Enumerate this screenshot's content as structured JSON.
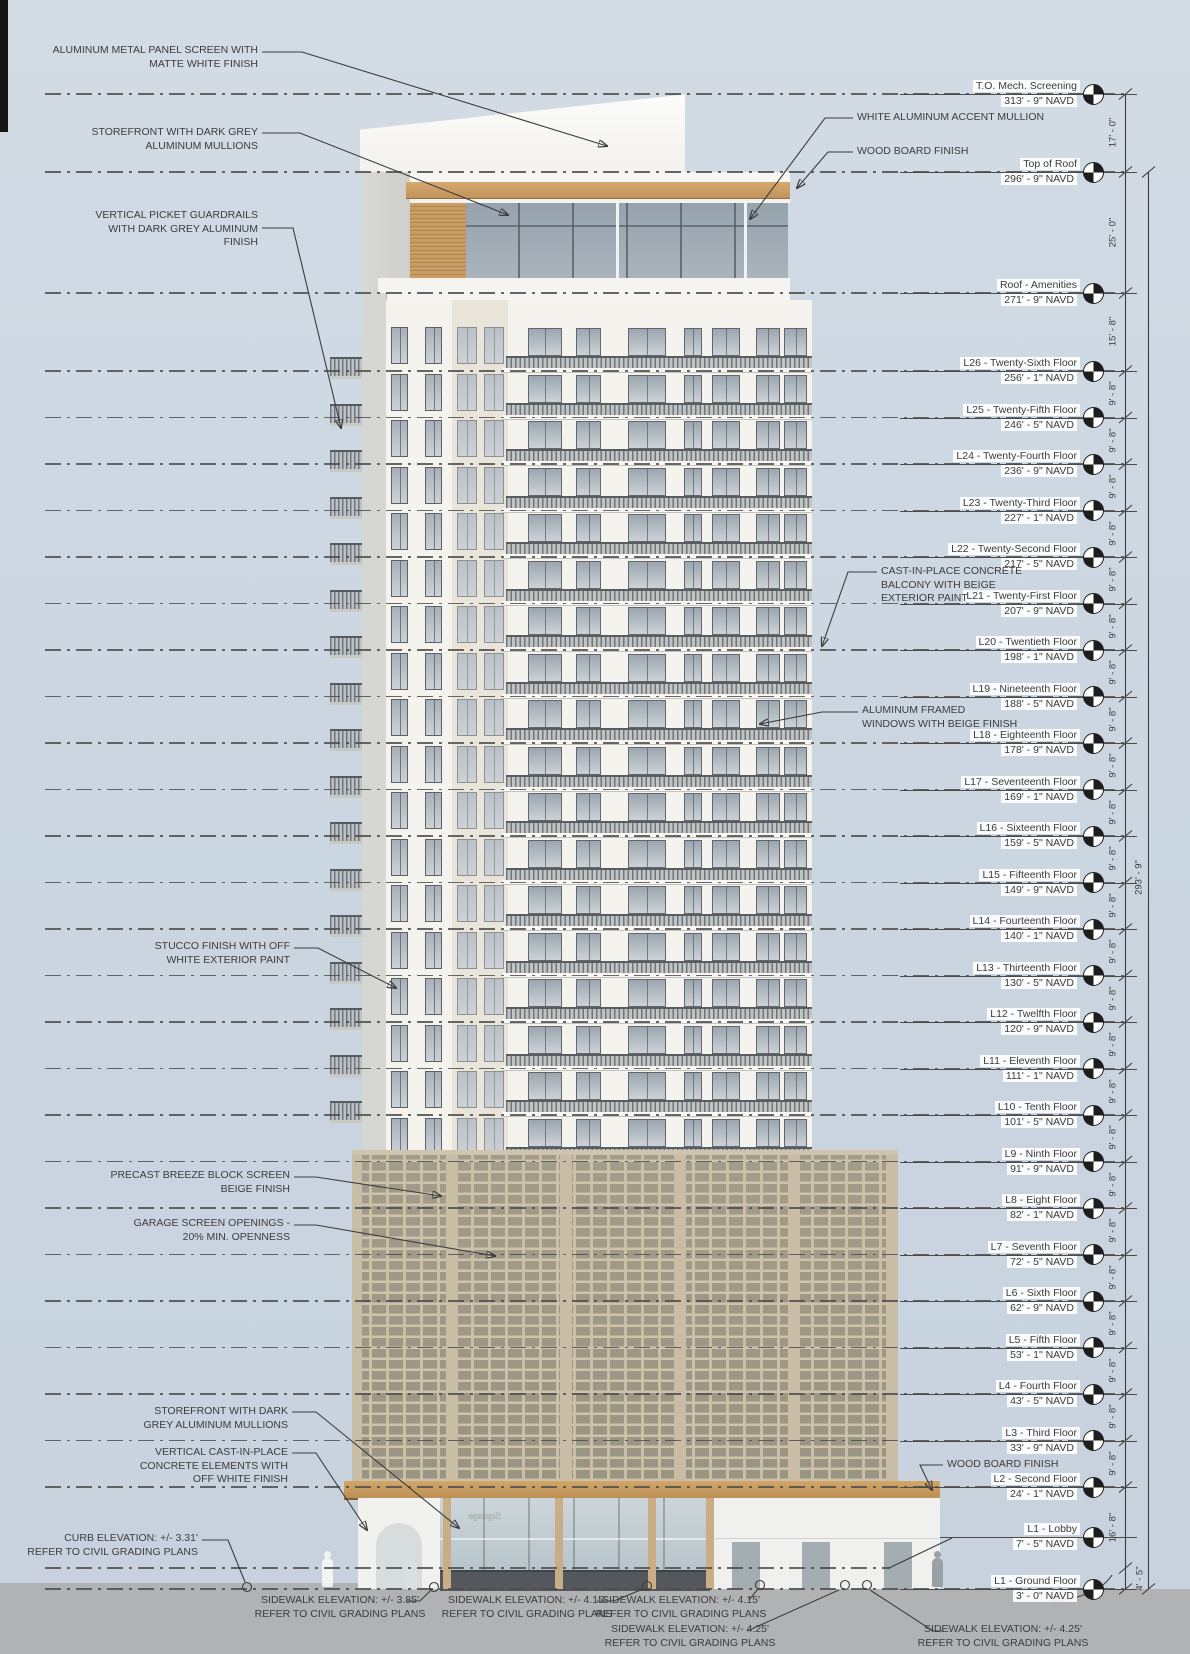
{
  "levels": [
    {
      "name": "T.O. Mech. Screening",
      "elevation": "313' - 9\" NAVD"
    },
    {
      "name": "Top of Roof",
      "elevation": "296' - 9\" NAVD"
    },
    {
      "name": "Roof - Amenities",
      "elevation": "271' - 9\" NAVD"
    },
    {
      "name": "L26 - Twenty-Sixth Floor",
      "elevation": "256' - 1\" NAVD"
    },
    {
      "name": "L25 - Twenty-Fifth Floor",
      "elevation": "246' - 5\" NAVD"
    },
    {
      "name": "L24 - Twenty-Fourth Floor",
      "elevation": "236' - 9\" NAVD"
    },
    {
      "name": "L23 - Twenty-Third Floor",
      "elevation": "227' - 1\" NAVD"
    },
    {
      "name": "L22 - Twenty-Second Floor",
      "elevation": "217' - 5\" NAVD"
    },
    {
      "name": "L21 - Twenty-First Floor",
      "elevation": "207' - 9\" NAVD"
    },
    {
      "name": "L20 - Twentieth Floor",
      "elevation": "198' - 1\" NAVD"
    },
    {
      "name": "L19 - Nineteenth Floor",
      "elevation": "188' - 5\" NAVD"
    },
    {
      "name": "L18 - Eighteenth Floor",
      "elevation": "178' - 9\" NAVD"
    },
    {
      "name": "L17 - Seventeenth Floor",
      "elevation": "169' - 1\" NAVD"
    },
    {
      "name": "L16 - Sixteenth Floor",
      "elevation": "159' - 5\" NAVD"
    },
    {
      "name": "L15 - Fifteenth Floor",
      "elevation": "149' - 9\" NAVD"
    },
    {
      "name": "L14 - Fourteenth Floor",
      "elevation": "140' - 1\" NAVD"
    },
    {
      "name": "L13 - Thirteenth Floor",
      "elevation": "130' - 5\" NAVD"
    },
    {
      "name": "L12 - Twelfth Floor",
      "elevation": "120' - 9\" NAVD"
    },
    {
      "name": "L11 - Eleventh Floor",
      "elevation": "111' - 1\" NAVD"
    },
    {
      "name": "L10 - Tenth Floor",
      "elevation": "101' - 5\" NAVD"
    },
    {
      "name": "L9 - Ninth Floor",
      "elevation": "91' - 9\" NAVD"
    },
    {
      "name": "L8 - Eight Floor",
      "elevation": "82' - 1\" NAVD"
    },
    {
      "name": "L7 - Seventh Floor",
      "elevation": "72' - 5\" NAVD"
    },
    {
      "name": "L6 - Sixth Floor",
      "elevation": "62' - 9\" NAVD"
    },
    {
      "name": "L5 - Fifth Floor",
      "elevation": "53' - 1\" NAVD"
    },
    {
      "name": "L4 - Fourth Floor",
      "elevation": "43' - 5\" NAVD"
    },
    {
      "name": "L3 - Third Floor",
      "elevation": "33' - 9\" NAVD"
    },
    {
      "name": "L2 - Second Floor",
      "elevation": "24' - 1\" NAVD"
    },
    {
      "name": "L1 - Lobby",
      "elevation": "7' - 5\" NAVD"
    },
    {
      "name": "L1 - Ground Floor",
      "elevation": "3' - 0\" NAVD"
    }
  ],
  "dimensions": {
    "intervals": [
      "17' - 0\"",
      "25' - 0\"",
      "15' - 8\"",
      "9' - 8\"",
      "9' - 8\"",
      "9' - 8\"",
      "9' - 8\"",
      "9' - 8\"",
      "9' - 8\"",
      "9' - 8\"",
      "9' - 8\"",
      "9' - 8\"",
      "9' - 8\"",
      "9' - 8\"",
      "9' - 8\"",
      "9' - 8\"",
      "9' - 8\"",
      "9' - 8\"",
      "9' - 8\"",
      "9' - 8\"",
      "9' - 8\"",
      "9' - 8\"",
      "9' - 8\"",
      "9' - 8\"",
      "9' - 8\"",
      "9' - 8\"",
      "9' - 8\"",
      "16' - 8\"",
      "4' - 5\""
    ],
    "overall": "293' - 9\""
  },
  "callouts_left": [
    {
      "id": "aluminum-panel-screen",
      "lines": [
        "ALUMINUM METAL PANEL SCREEN WITH",
        "MATTE WHITE FINISH"
      ]
    },
    {
      "id": "storefront-mullions-top",
      "lines": [
        "STOREFRONT WITH DARK GREY",
        "ALUMINUM MULLIONS"
      ]
    },
    {
      "id": "picket-guardrails",
      "lines": [
        "VERTICAL PICKET GUARDRAILS",
        "WITH DARK GREY ALUMINUM",
        "FINISH"
      ]
    },
    {
      "id": "stucco-finish",
      "lines": [
        "STUCCO FINISH WITH OFF",
        "WHITE EXTERIOR PAINT"
      ]
    },
    {
      "id": "breeze-block-screen",
      "lines": [
        "PRECAST BREEZE BLOCK SCREEN",
        "BEIGE FINISH"
      ]
    },
    {
      "id": "garage-screen-openings",
      "lines": [
        "GARAGE SCREEN OPENINGS -",
        "20% MIN. OPENNESS"
      ]
    },
    {
      "id": "storefront-mullions-bottom",
      "lines": [
        "STOREFRONT WITH DARK",
        "GREY ALUMINUM MULLIONS"
      ]
    },
    {
      "id": "cast-in-place-elements",
      "lines": [
        "VERTICAL CAST-IN-PLACE",
        "CONCRETE ELEMENTS WITH",
        "OFF WHITE FINISH"
      ]
    }
  ],
  "callouts_right": [
    {
      "id": "accent-mullion",
      "lines": [
        "WHITE ALUMINUM ACCENT MULLION"
      ]
    },
    {
      "id": "wood-board-top",
      "lines": [
        "WOOD BOARD FINISH"
      ]
    },
    {
      "id": "concrete-balcony",
      "lines": [
        "CAST-IN-PLACE CONCRETE",
        "BALCONY WITH BEIGE",
        "EXTERIOR PAINT"
      ]
    },
    {
      "id": "aluminum-windows",
      "lines": [
        "ALUMINUM FRAMED",
        "WINDOWS WITH BEIGE FINISH"
      ]
    },
    {
      "id": "wood-board-bottom",
      "lines": [
        "WOOD BOARD FINISH"
      ]
    }
  ],
  "ground_notes": [
    {
      "id": "curb-elevation",
      "lines": [
        "CURB ELEVATION: +/- 3.31'",
        "REFER TO CIVIL GRADING PLANS"
      ]
    },
    {
      "id": "sidewalk-385",
      "lines": [
        "SIDEWALK ELEVATION: +/- 3.85'",
        "REFER TO CIVIL GRADING PLANS"
      ]
    },
    {
      "id": "sidewalk-415-a",
      "lines": [
        "SIDEWALK ELEVATION: +/- 4.15'",
        "REFER TO CIVIL GRADING PLANS"
      ]
    },
    {
      "id": "sidewalk-415-b",
      "lines": [
        "SIDEWALK ELEVATION: +/- 4.15'",
        "REFER TO CIVIL GRADING PLANS"
      ]
    },
    {
      "id": "sidewalk-425-a",
      "lines": [
        "SIDEWALK ELEVATION: +/- 4.25'",
        "REFER TO CIVIL GRADING PLANS"
      ]
    },
    {
      "id": "sidewalk-425-b",
      "lines": [
        "SIDEWALK ELEVATION: +/- 4.25'",
        "REFER TO CIVIL GRADING PLANS"
      ]
    }
  ],
  "glass_signage": "Signage",
  "colors": {
    "background": "#ccd6e1",
    "ground": "#b1b2b3",
    "facade_white": "#f4f3ee",
    "wood": "#c79d63",
    "breeze_block": "#c4b79f",
    "glass": "#9aa6b0",
    "annotation": "#3c3c3c"
  }
}
